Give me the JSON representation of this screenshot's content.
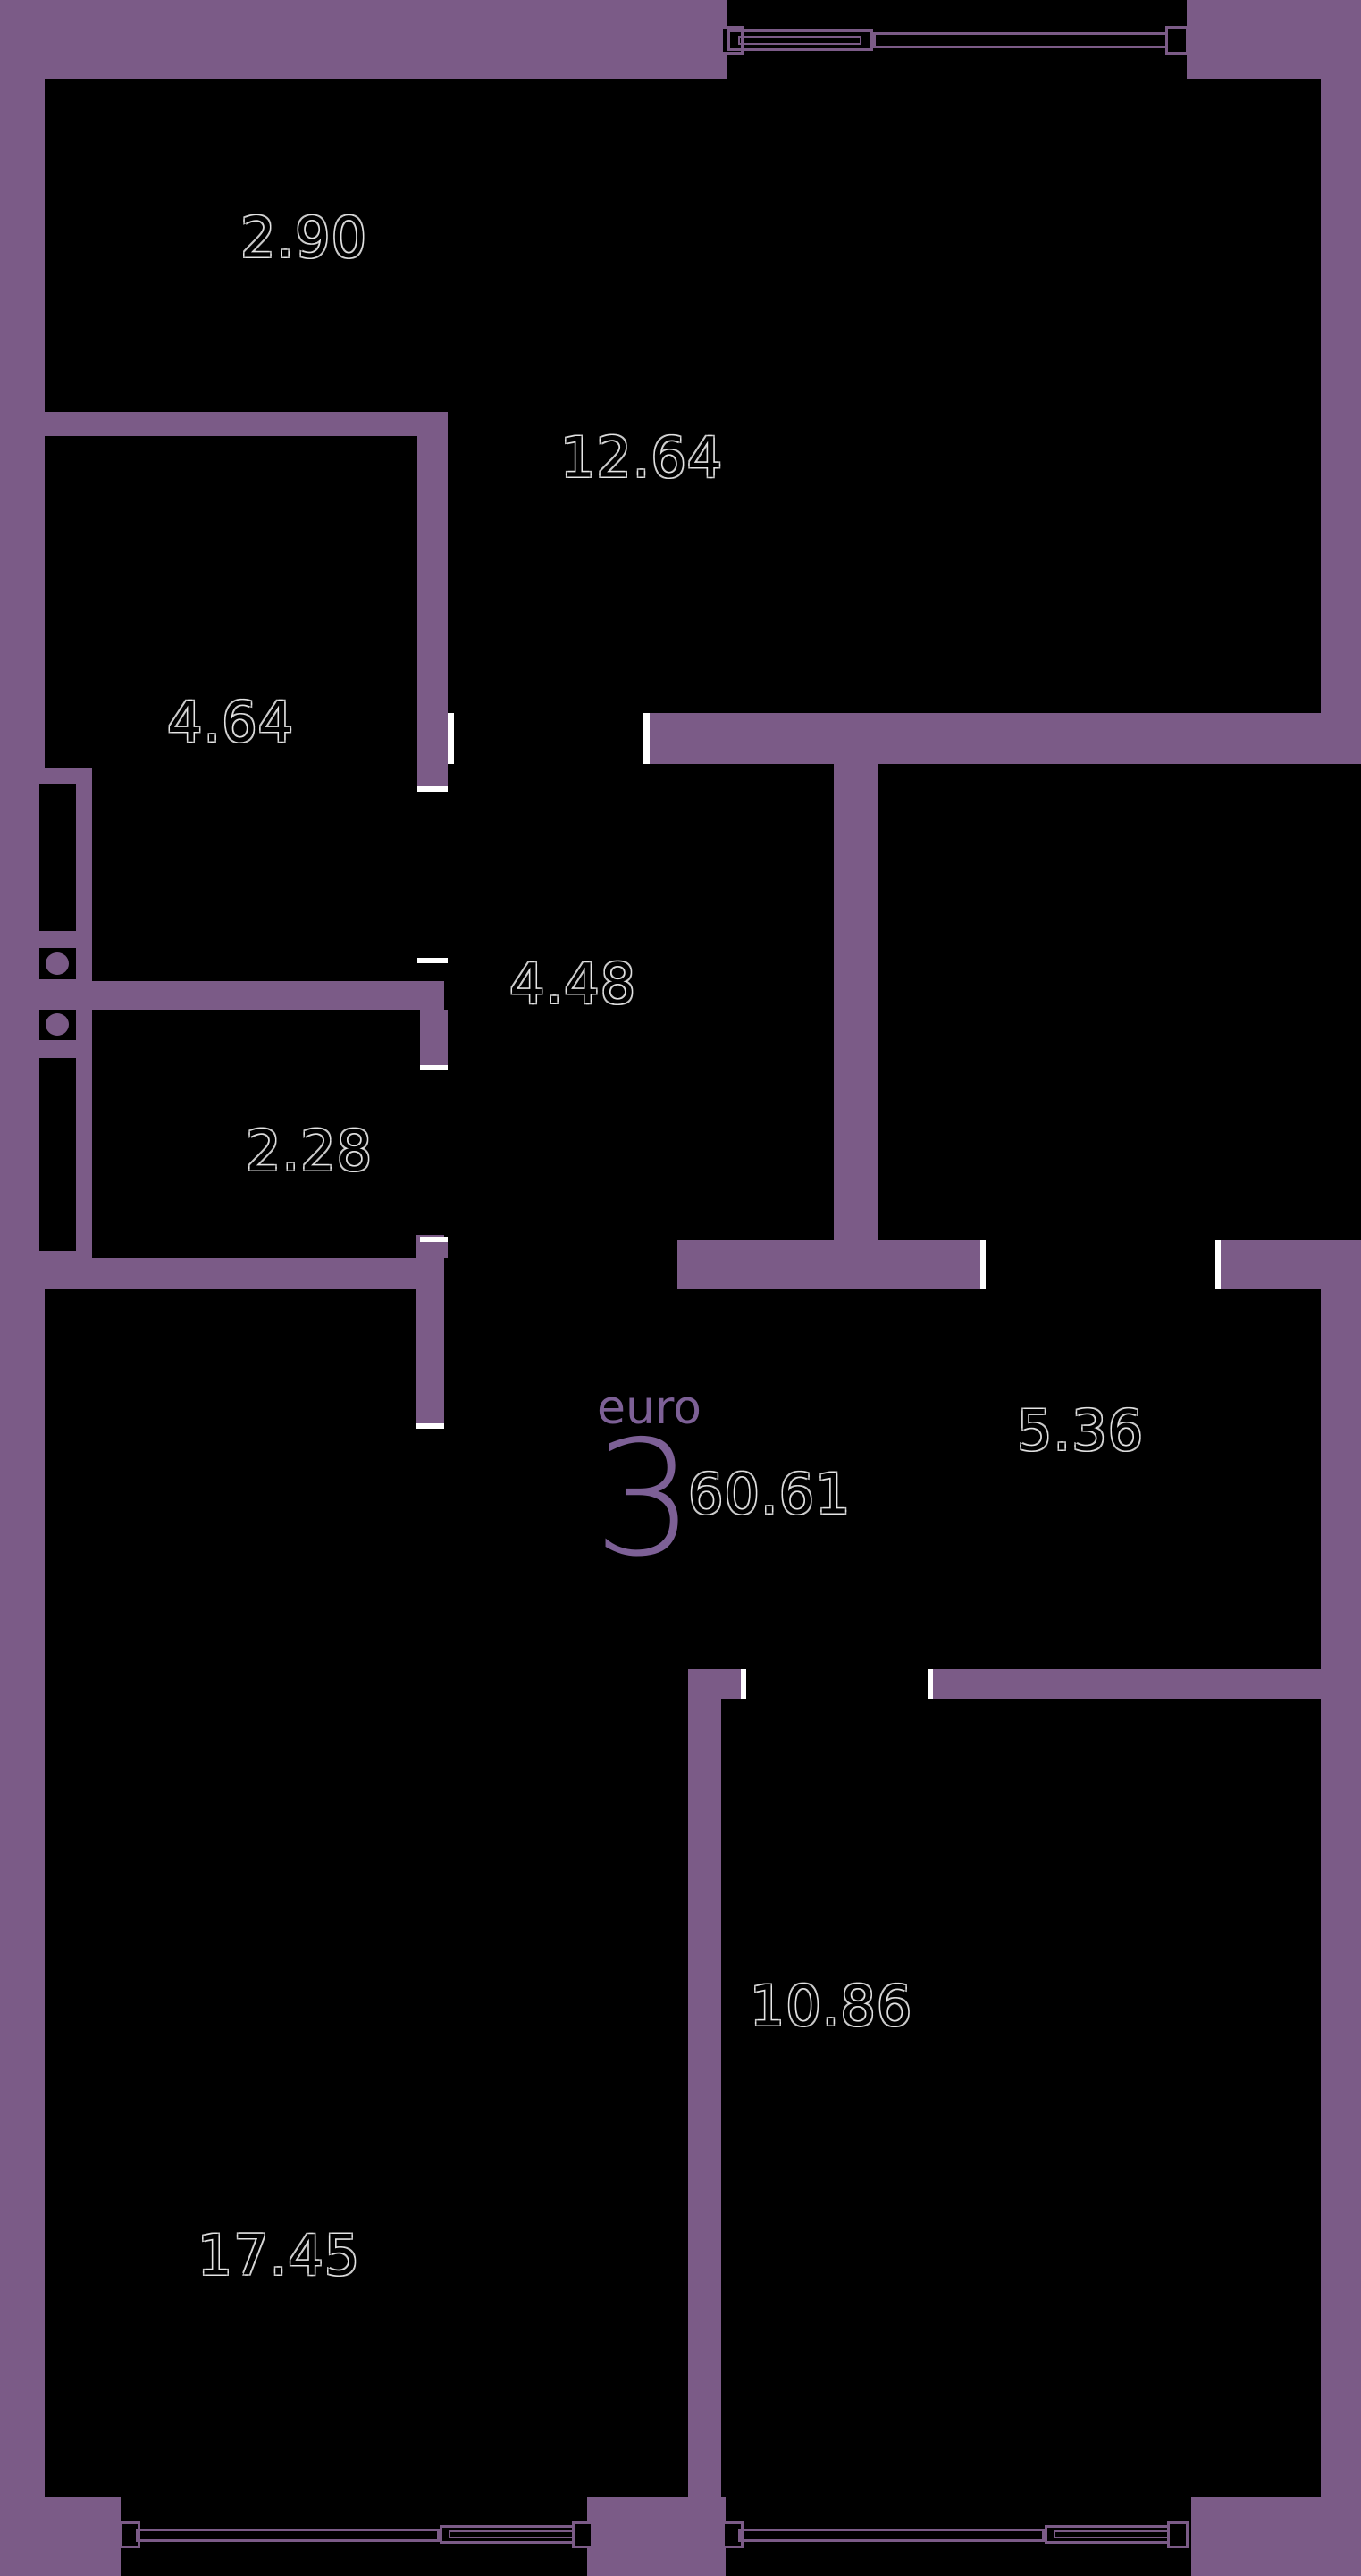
{
  "title": "Euro 3-room apartment floor plan",
  "unit": {
    "layout_label": "euro",
    "rooms_count": "3",
    "total_area": "60.61"
  },
  "rooms": [
    {
      "id": "balcony-top",
      "area": "2.90"
    },
    {
      "id": "room-top-right",
      "area": "12.64"
    },
    {
      "id": "room-mid-left",
      "area": "4.64"
    },
    {
      "id": "hallway-center",
      "area": "4.48"
    },
    {
      "id": "bath-small-left",
      "area": "2.28"
    },
    {
      "id": "corridor-right",
      "area": "5.36"
    },
    {
      "id": "bedroom-bottom-right",
      "area": "10.86"
    },
    {
      "id": "living-bottom-left",
      "area": "17.45"
    }
  ],
  "colors": {
    "wall": "#7b5b87",
    "interior": "#000000",
    "accent": "#7d6096",
    "tick": "#ffffff"
  }
}
